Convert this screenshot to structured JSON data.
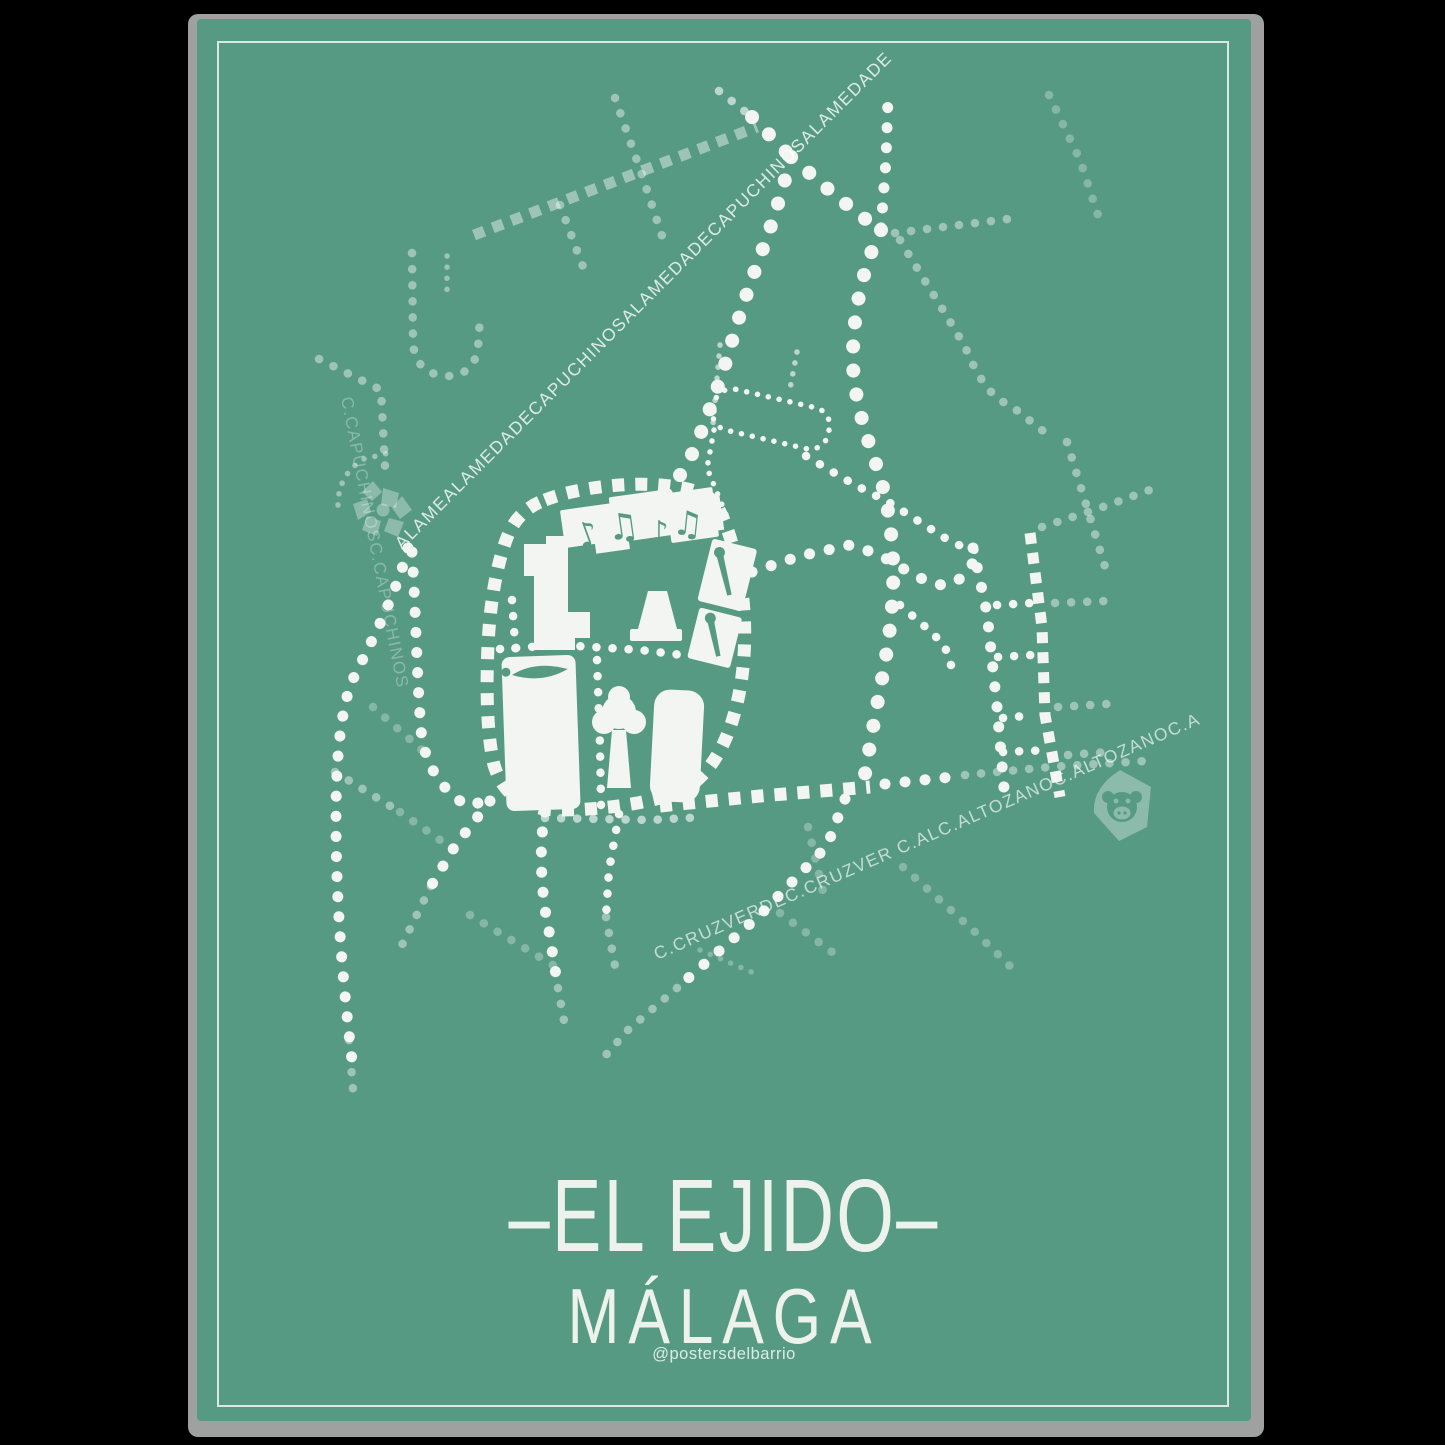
{
  "poster": {
    "title": "–EL EJIDO–",
    "subtitle": "MÁLAGA",
    "attribution": "@postersdelbarrio",
    "street_labels": {
      "alameda": "ALAMEALAMEDADECAPUCHINOSALAMEDADECAPUCHINOSALAMEDADE",
      "capuchinos": "C.CAPUCHINOSC.CAPUCHINOS",
      "cruzverde_altozano": "C.CRUZVERDEC.CRUZVER C.ALC.ALTOZANOC.ALTOZANOC.A"
    },
    "colors": {
      "background": "#569a84",
      "street_bright": "#f2f5f2",
      "street_faded": "rgba(255,255,255,0.30)",
      "frame_line": "#eef4ef",
      "paper_edge": "#9fa0a0",
      "title_text": "#edf2ed",
      "outside": "#000000"
    },
    "icons": [
      "flower-icon",
      "monkey-logo-icon",
      "music-notes-icon",
      "paintbrush-icon",
      "tree-icon"
    ]
  }
}
